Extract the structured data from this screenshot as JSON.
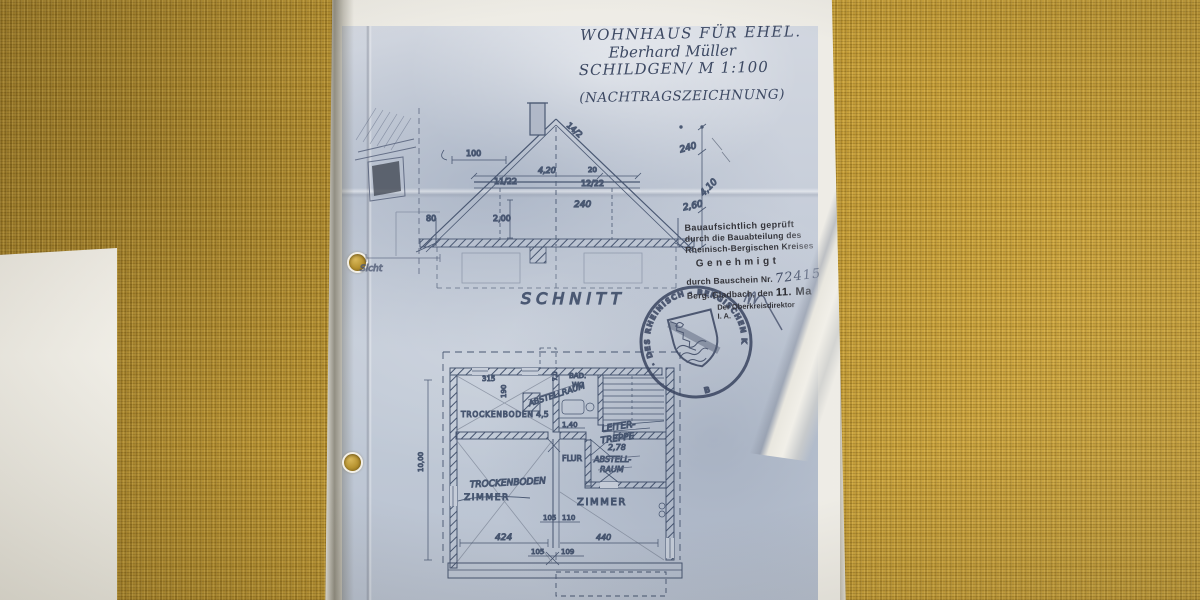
{
  "title_block": {
    "line1": "WOHNHAUS FÜR EHEL.",
    "line2": "Eberhard Müller",
    "line3": "SCHILDGEN/ M 1:100",
    "note": "(NACHTRAGSZEICHNUNG)"
  },
  "section": {
    "label": "SCHNITT",
    "dims": {
      "span_top": "100",
      "pitch": "14/2",
      "collar_width": "4,20",
      "offset": "20",
      "rafter_left": "11/22",
      "rafter_right": "12/22",
      "height_mid": "240",
      "height_left": "2,00",
      "knee": "80",
      "right_top": "240",
      "right_mid": "4,10",
      "right_low": "2,60"
    }
  },
  "floor_plan": {
    "rooms": {
      "trockenboden_top": "TROCKENBODEN",
      "trockenboden_top_dim": "4,5",
      "abstell_pencil": "ABSTELLRAUM",
      "bad": "BAD.",
      "wc": "WC",
      "bad_dim": "7,0",
      "leiter_line1": "LEITER-",
      "leiter_line2": "TREPPE",
      "flur": "FLUR",
      "abstellraum_line1": "ABSTELL-",
      "abstellraum_line2": "RAUM",
      "abstellraum_dim": "2,78",
      "trockenboden_pencil": "TROCKENBODEN",
      "zimmer_left": "ZIMMER",
      "zimmer_right": "ZIMMER"
    },
    "dims": {
      "d315": "315",
      "d190": "190",
      "d140": "1,40",
      "d105a": "105",
      "d110a": "110",
      "d424": "424",
      "d105b": "105",
      "d109b": "109",
      "d440": "440",
      "d1000": "10,00"
    }
  },
  "approval_stamp": {
    "line1": "Bauaufsichtlich geprüft",
    "line2": "durch die Bauabteilung des",
    "line3": "Rheinisch-Bergischen Kreises",
    "line4": "Genehmigt",
    "line5_label": "durch Bauschein Nr.",
    "line5_value": "72415",
    "line6_label": "Berg. Gladbach, den",
    "line6_value": "11. Ma",
    "line7": "Der Oberkreisdirektor",
    "line8": "I. A.",
    "line9": "(Kreisbau"
  },
  "seal": {
    "ring_text": "· DES RHEINISCH - BERGISCHEN KREISES ·",
    "bottom_letter": "B"
  },
  "fragment": {
    "caption": "Sicht"
  }
}
